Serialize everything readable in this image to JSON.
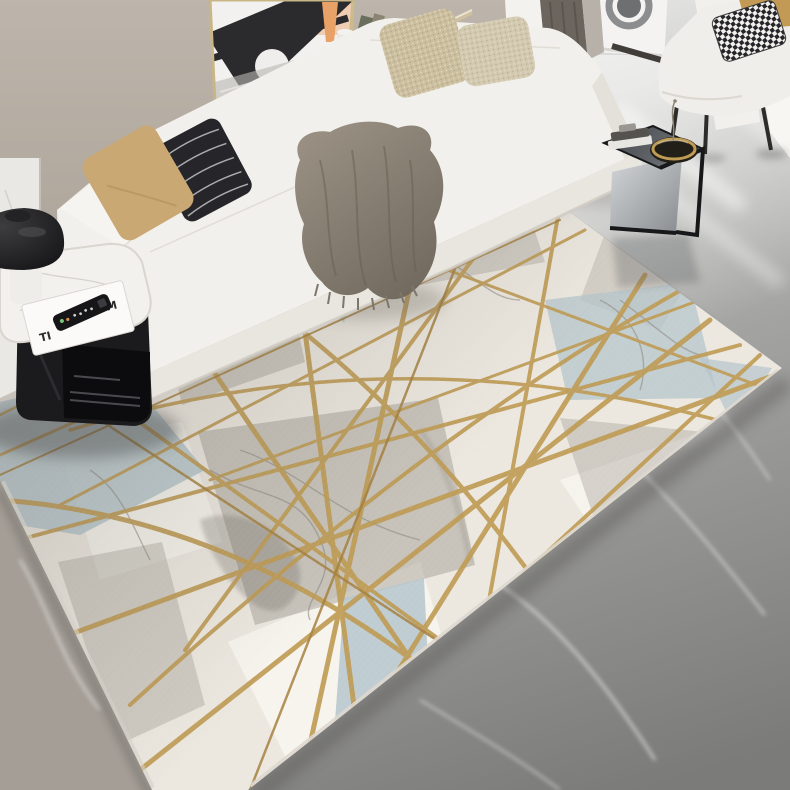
{
  "meta": {
    "type": "product-photograph",
    "subject": "Geometric marble-pattern area rug with criss-crossing gold lines",
    "setting": "Modern living room with white L-shaped sectional sofa on gray marble floor",
    "visible_text_note": "Only stylized letters on a magazine cover are visible"
  },
  "palette": {
    "wall": "#b8afa5",
    "wall_panel": "#eae8e4",
    "floor_hi": "#e0e0de",
    "floor_mid": "#9c9c9a",
    "floor_lo": "#7b7b79",
    "floor_warm": "#a49e96",
    "rug_base": "#ece8e0",
    "rug_white": "#f8f5ef",
    "rug_gray": "#9b968c",
    "rug_blue": "#b5c5cc",
    "rug_gold": "#bf9c55",
    "rug_gold_dark": "#a6813f",
    "sofa": "#f2f0ec",
    "sofa_shade": "#ddd9d2",
    "throw_hi": "#958e82",
    "throw_lo": "#6f685d",
    "pillow_tan": "#c9a873",
    "pillow_black": "#26262a",
    "pillow_champagne": "#cbbf9f",
    "pillow_champagne2": "#d2c9b0",
    "armchair_tan": "#c29a55",
    "table_black": "#1b1b1d",
    "marble_top": "#f3f1ed",
    "ctable_dark": "#2f3237",
    "bowl_inner": "#221f18",
    "curtain_dark": "#6b655e",
    "curtain_light": "#b7b1a9",
    "art_black": "#2b2b2d",
    "art_peach": "#e8a268"
  },
  "magazine": {
    "letters": [
      "TI",
      "D",
      "M"
    ]
  },
  "scene": {
    "objects": [
      {
        "name": "framed-bridge-artwork",
        "desc": "black and white bridge print with peach tower in thin gold frame leaning on wall"
      },
      {
        "name": "floating-shelf-books",
        "desc": "gold-edged ledge with leaning books"
      },
      {
        "name": "white-sculpture",
        "desc": "small white organic sculpture on ledge"
      },
      {
        "name": "dark-curtain",
        "desc": "dark gray-brown curtain panel"
      },
      {
        "name": "washing-machine",
        "desc": "white appliance with round door in hallway"
      },
      {
        "name": "accent-armchair",
        "desc": "white armchair with black metal legs"
      },
      {
        "name": "houndstooth-pillow",
        "desc": "black and white houndstooth cushion"
      },
      {
        "name": "white-sectional-sofa",
        "desc": "white L-shaped chaise sectional"
      },
      {
        "name": "tan-pillow",
        "desc": "camel leather-look cushion"
      },
      {
        "name": "black-stripe-pillow",
        "desc": "black cushion with thin white stripes"
      },
      {
        "name": "champagne-sequin-pillows",
        "desc": "two textured champagne cushions on chaise"
      },
      {
        "name": "gray-fringed-throw",
        "desc": "gray throw blanket with fringe draped over sofa corner"
      },
      {
        "name": "black-side-table",
        "desc": "black cube side table with white marble top"
      },
      {
        "name": "black-mushroom-lamp",
        "desc": "glossy black dome lamp"
      },
      {
        "name": "magazine",
        "desc": "white magazine under remote"
      },
      {
        "name": "tv-remote",
        "desc": "black television remote control"
      },
      {
        "name": "c-shaped-end-table",
        "desc": "black steel C-table with books and gold-rim bowl"
      },
      {
        "name": "gold-rim-bowl",
        "desc": "dark bowl with brass rim"
      },
      {
        "name": "geometric-rug",
        "desc": "ivory / gray / pale-blue marble rug with gold geometric lines"
      },
      {
        "name": "gray-marble-floor",
        "desc": "large-format gray marble tile floor"
      }
    ]
  }
}
